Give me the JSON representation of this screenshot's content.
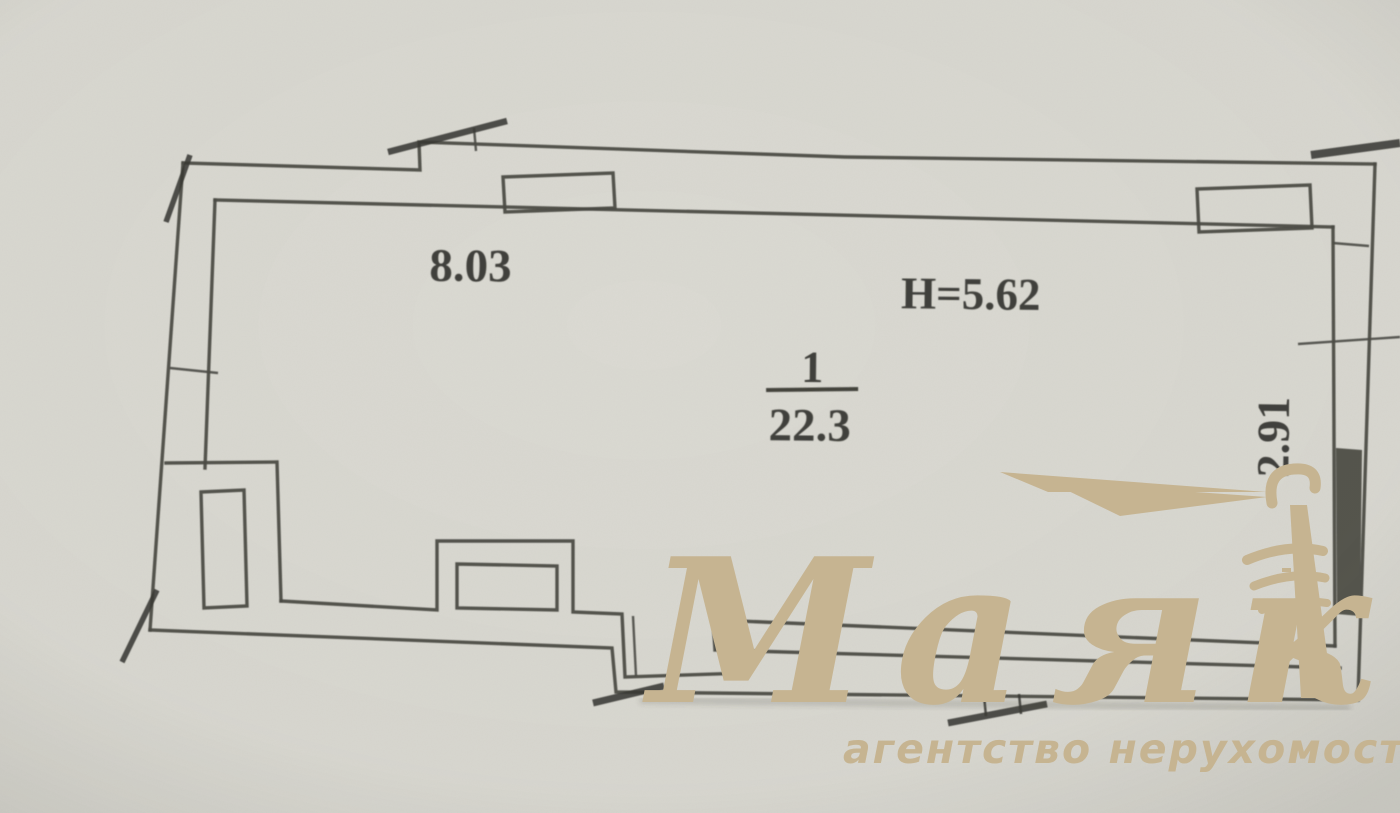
{
  "plan": {
    "dimensions": {
      "top_width": "8.03",
      "ceiling_height": "H=5.62",
      "right_width": "2.91"
    },
    "room": {
      "number": "1",
      "area": "22.3"
    }
  },
  "watermark": {
    "brand": "Маяк",
    "tagline": "агентство нерухомості",
    "color": "#c6b491"
  },
  "colors": {
    "paper": "#dad9d2",
    "ink": "#4b4b45",
    "tick": "#3a3a34",
    "window_fill": "#54554d",
    "text": "#34342f"
  }
}
